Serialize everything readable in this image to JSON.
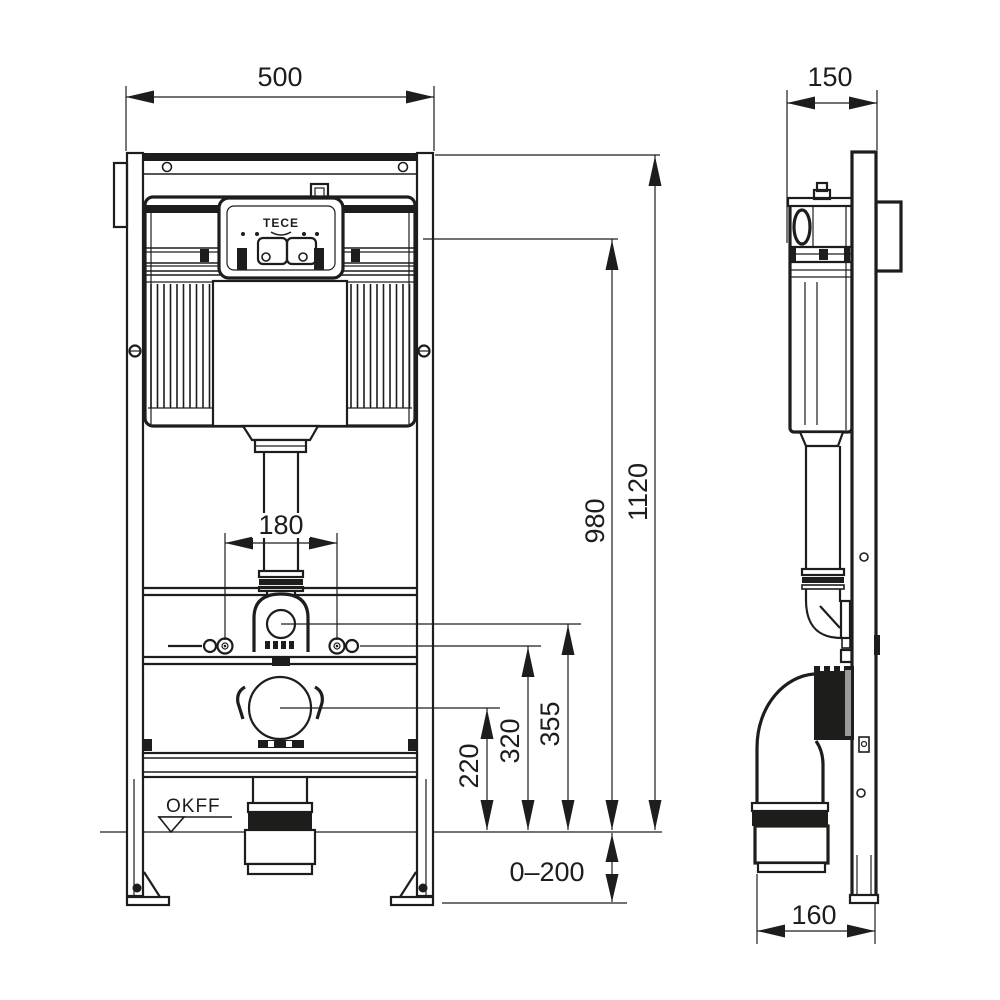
{
  "labels": {
    "logo": "TECE",
    "floor_level": "OKFF"
  },
  "dimensions": {
    "front_width": "500",
    "frame_depth": "150",
    "total_height": "1120",
    "actuation_height": "980",
    "stud_spacing": "180",
    "flush_bend_height": "355",
    "stud_height": "320",
    "outlet_height": "220",
    "leg_adjustment": "0–200",
    "outlet_offset": "160"
  },
  "colors": {
    "line": "#1d1d1b",
    "background": "#ffffff",
    "accent_gray": "#9a9a9a"
  }
}
